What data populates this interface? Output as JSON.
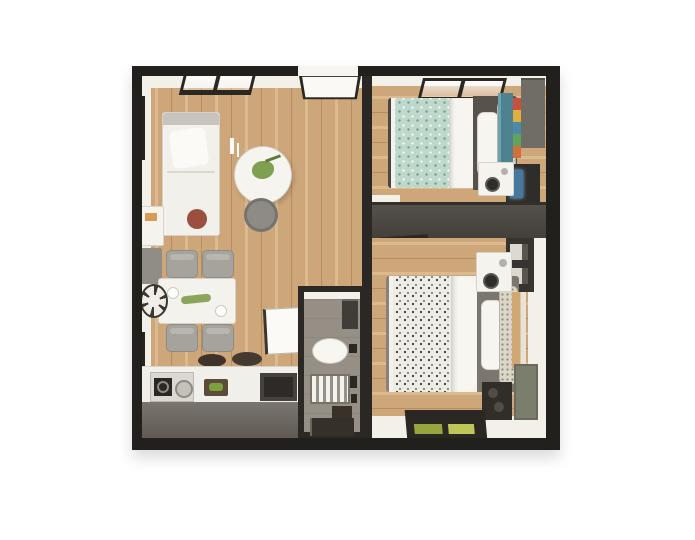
{
  "scene": {
    "type": "3d-floor-plan-top-view",
    "description": "Top-down 3D rendered floor plan of a two-bedroom apartment with open living/dining/kitchen area, central bathroom, and two bedrooms on the right; thick dark walls on a white background; no text labels visible.",
    "rooms": [
      {
        "name": "living-dining-kitchen",
        "floor": "light oak wood, vertical planks",
        "furniture": [
          "white sofa with brown round cushion",
          "round white coffee table with green plant",
          "gray round stool",
          "white candle sticks",
          "white side shelf with orange book",
          "gray cabinet",
          "wall clock",
          "white dining table with plants and plates",
          "four gray dining chairs",
          "kitchen counter with gas stove",
          "steel pot",
          "two dark pans",
          "cutting board with greens",
          "dark sink appliance"
        ],
        "windows": [
          "top wall picture window",
          "left wall window upper",
          "left wall window lower"
        ],
        "doors": [
          "entry door at top wall (open)",
          "bathroom door (open leaf)"
        ]
      },
      {
        "name": "bathroom",
        "floor": "gray tile",
        "furniture": [
          "corner shelf unit",
          "white toilet",
          "slatted shower tray",
          "dark fixtures",
          "dark stool box",
          "bottom wall window"
        ]
      },
      {
        "name": "bedroom-top-right",
        "floor": "light oak wood, horizontal planks",
        "furniture": [
          "double bed with teal spotted blanket and white pillows",
          "dark gray bed frame",
          "teal wardrobe",
          "shelf with colorful items",
          "gray closet",
          "white nightstand",
          "dark media unit with blue TV screen"
        ],
        "windows": [
          "top wall window"
        ]
      },
      {
        "name": "bedroom-bottom-right",
        "floor": "light oak wood, horizontal planks",
        "furniture": [
          "double bed with floral blanket and white pillows",
          "gray bed frame",
          "white nightstand with lamp",
          "dark shelf unit",
          "tan closet panels",
          "olive cabinet",
          "dark speaker box"
        ],
        "windows": [
          "bottom wall window with greenery outside"
        ],
        "doors": [
          "open door leaf against divider wall"
        ]
      }
    ],
    "walls": [
      "thick dark outer walls",
      "vertical wall separating left zone from bedrooms",
      "dark gray divider wall between bedrooms"
    ]
  },
  "palette": {
    "page_bg": "#ffffff",
    "wall": "#22201c",
    "wall_face": "#f3f0ea",
    "wood": "#cda67a",
    "wood_light": "#dcba8f",
    "wood_dark": "#b78d5f",
    "divider_wall": "#55504a",
    "tile": "#968f85",
    "teal_blanket": "#bed9cc",
    "floral_blanket": "#edece6",
    "bed_frame_dark": "#57534c",
    "bed_frame_gray": "#7b766e",
    "counter_front": "#7a756e",
    "plant_green": "#7fa050",
    "window_green": "#a9bc4e",
    "wardrobe_teal": "#4f8291",
    "closet_tan": "#cfa873",
    "cabinet_olive": "#7b7e6d",
    "tv_screen_blue": "#46789f",
    "cushion_brown": "#9a4f3f",
    "dark_fixture": "#332f2b"
  }
}
